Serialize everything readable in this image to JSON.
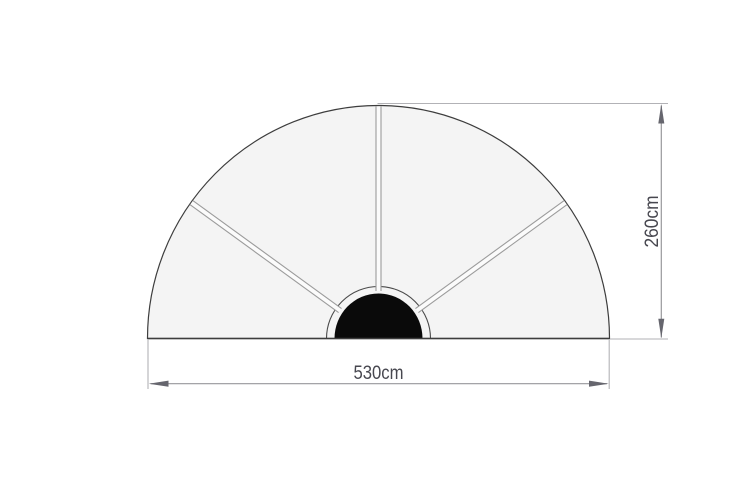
{
  "diagram": {
    "title": "half-round canopy dimension drawing",
    "shape": {
      "type": "semicircle",
      "panels": 4,
      "ribs": 3,
      "rib_angles_deg": [
        36,
        90,
        144
      ],
      "hub": "half-round center pole mount"
    },
    "dimensions": {
      "width_value_cm": 530,
      "height_value_cm": 260
    },
    "labels": {
      "width": "530cm",
      "height": "260cm"
    },
    "colors": {
      "background": "#ffffff",
      "panel_fill": "#f4f4f4",
      "outline": "#3d3d3d",
      "rib_line": "#9b9b9b",
      "rib_band": "#fbfbfb",
      "hub_ring": "#4a4a4a",
      "hub_fill": "#0a0a0a",
      "extension_line": "#b2b2b6",
      "dimension_line": "#97979b",
      "arrow": "#66666e",
      "label_text": "#47474f"
    }
  }
}
